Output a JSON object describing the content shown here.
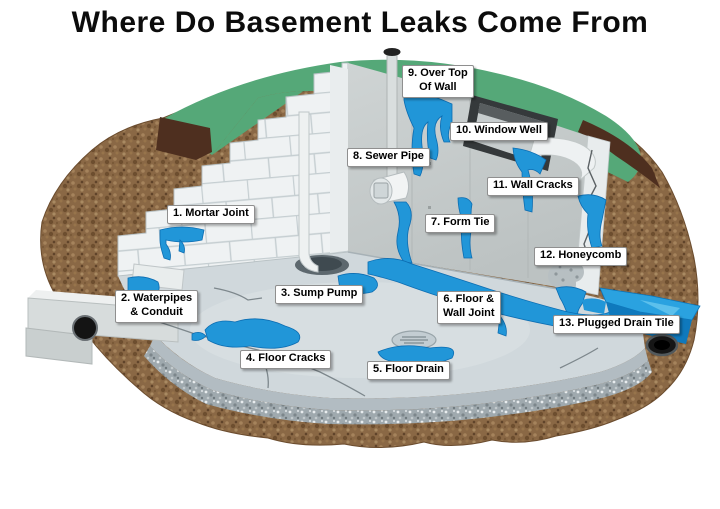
{
  "title": "Where Do Basement Leaks Come From",
  "diagram": {
    "description": "Cutaway illustration of a basement foundation showing 13 numbered leak sources",
    "labels": [
      {
        "id": "1",
        "name": "label-mortar-joint",
        "text": "1. Mortar Joint",
        "x": 167,
        "y": 205
      },
      {
        "id": "2",
        "name": "label-waterpipes-conduit",
        "text": "2. Waterpipes\n& Conduit",
        "x": 115,
        "y": 290
      },
      {
        "id": "3",
        "name": "label-sump-pump",
        "text": "3. Sump Pump",
        "x": 275,
        "y": 285
      },
      {
        "id": "4",
        "name": "label-floor-cracks",
        "text": "4. Floor Cracks",
        "x": 240,
        "y": 350
      },
      {
        "id": "5",
        "name": "label-floor-drain",
        "text": "5. Floor Drain",
        "x": 367,
        "y": 361
      },
      {
        "id": "6",
        "name": "label-floor-wall-joint",
        "text": "6. Floor &\nWall Joint",
        "x": 437,
        "y": 291
      },
      {
        "id": "7",
        "name": "label-form-tie",
        "text": "7. Form Tie",
        "x": 425,
        "y": 214
      },
      {
        "id": "8",
        "name": "label-sewer-pipe",
        "text": "8. Sewer Pipe",
        "x": 347,
        "y": 148
      },
      {
        "id": "9",
        "name": "label-over-top-of-wall",
        "text": "9. Over Top\nOf Wall",
        "x": 402,
        "y": 65
      },
      {
        "id": "10",
        "name": "label-window-well",
        "text": "10. Window Well",
        "x": 450,
        "y": 122
      },
      {
        "id": "11",
        "name": "label-wall-cracks",
        "text": "11. Wall Cracks",
        "x": 487,
        "y": 177
      },
      {
        "id": "12",
        "name": "label-honeycomb",
        "text": "12. Honeycomb",
        "x": 534,
        "y": 247
      },
      {
        "id": "13",
        "name": "label-plugged-drain-tile",
        "text": "13. Plugged Drain Tile",
        "x": 553,
        "y": 315
      }
    ],
    "colors": {
      "grass": "#55a878",
      "topsoil": "#4e2f1f",
      "soil": "#8a6845",
      "block_wall": "#eff2f3",
      "poured_wall": "#c6cccc",
      "floor": "#d0d8dc",
      "water": "#2196d8",
      "water_dark": "#0f79bd",
      "label_background": "#ffffff",
      "title_text": "#0c0c0c"
    }
  }
}
